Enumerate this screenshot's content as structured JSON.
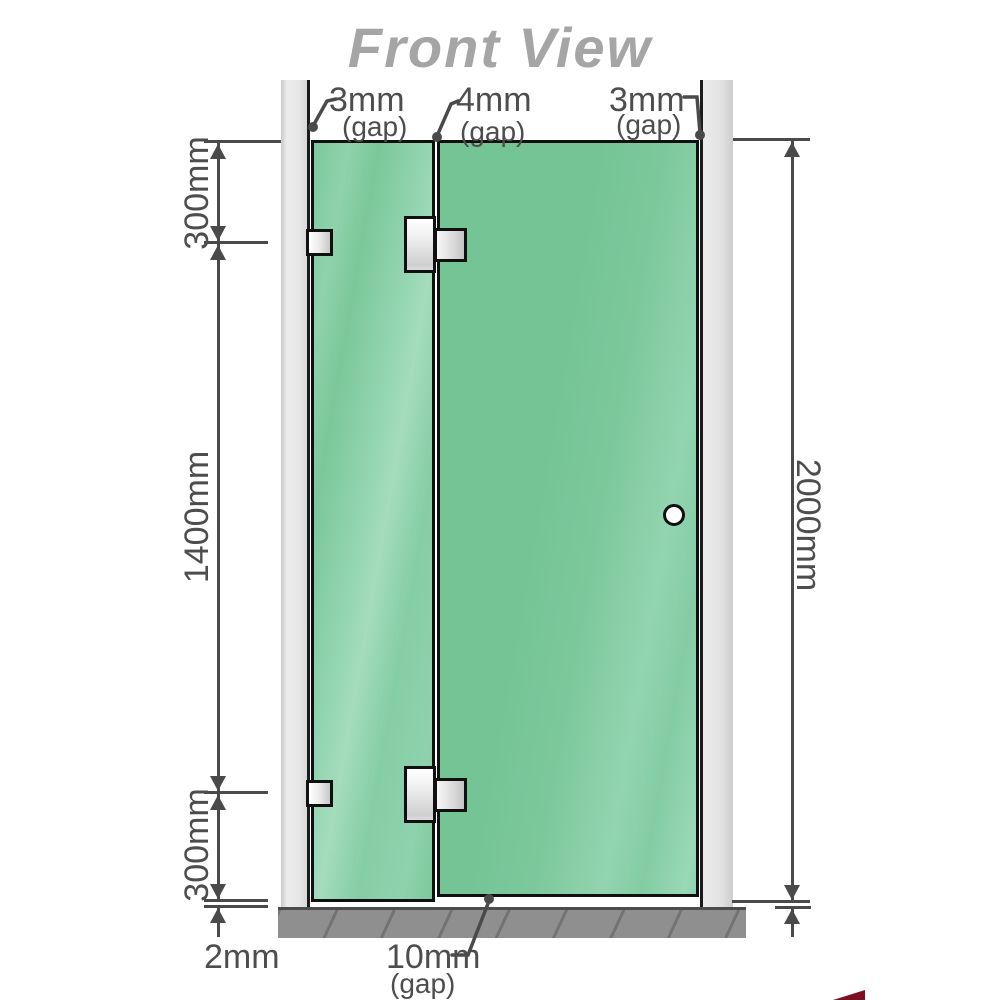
{
  "title": "Front View",
  "dimensions": {
    "top_gaps": [
      {
        "value": "3mm",
        "label": "(gap)"
      },
      {
        "value": "4mm",
        "label": "(gap)"
      },
      {
        "value": "3mm",
        "label": "(gap)"
      }
    ],
    "left_segments": {
      "top": "300mm",
      "middle": "1400mm",
      "bottom": "300mm",
      "floor_clearance": "2mm"
    },
    "right_total": "2000mm",
    "bottom_gap": {
      "value": "10mm",
      "label": "(gap)"
    }
  },
  "colors": {
    "glass_green": "#7cc89c",
    "glass_highlight": "#a4dcbc",
    "wall_channel_gray": "#e6e6e6",
    "floor_gray": "#8f8f8f",
    "outline_black": "#101010",
    "dimension_gray": "#4a4a4a",
    "title_gray": "#a5a5a5",
    "hardware_silver": "#dcdcdc",
    "watermark_red": "#7d1022"
  }
}
